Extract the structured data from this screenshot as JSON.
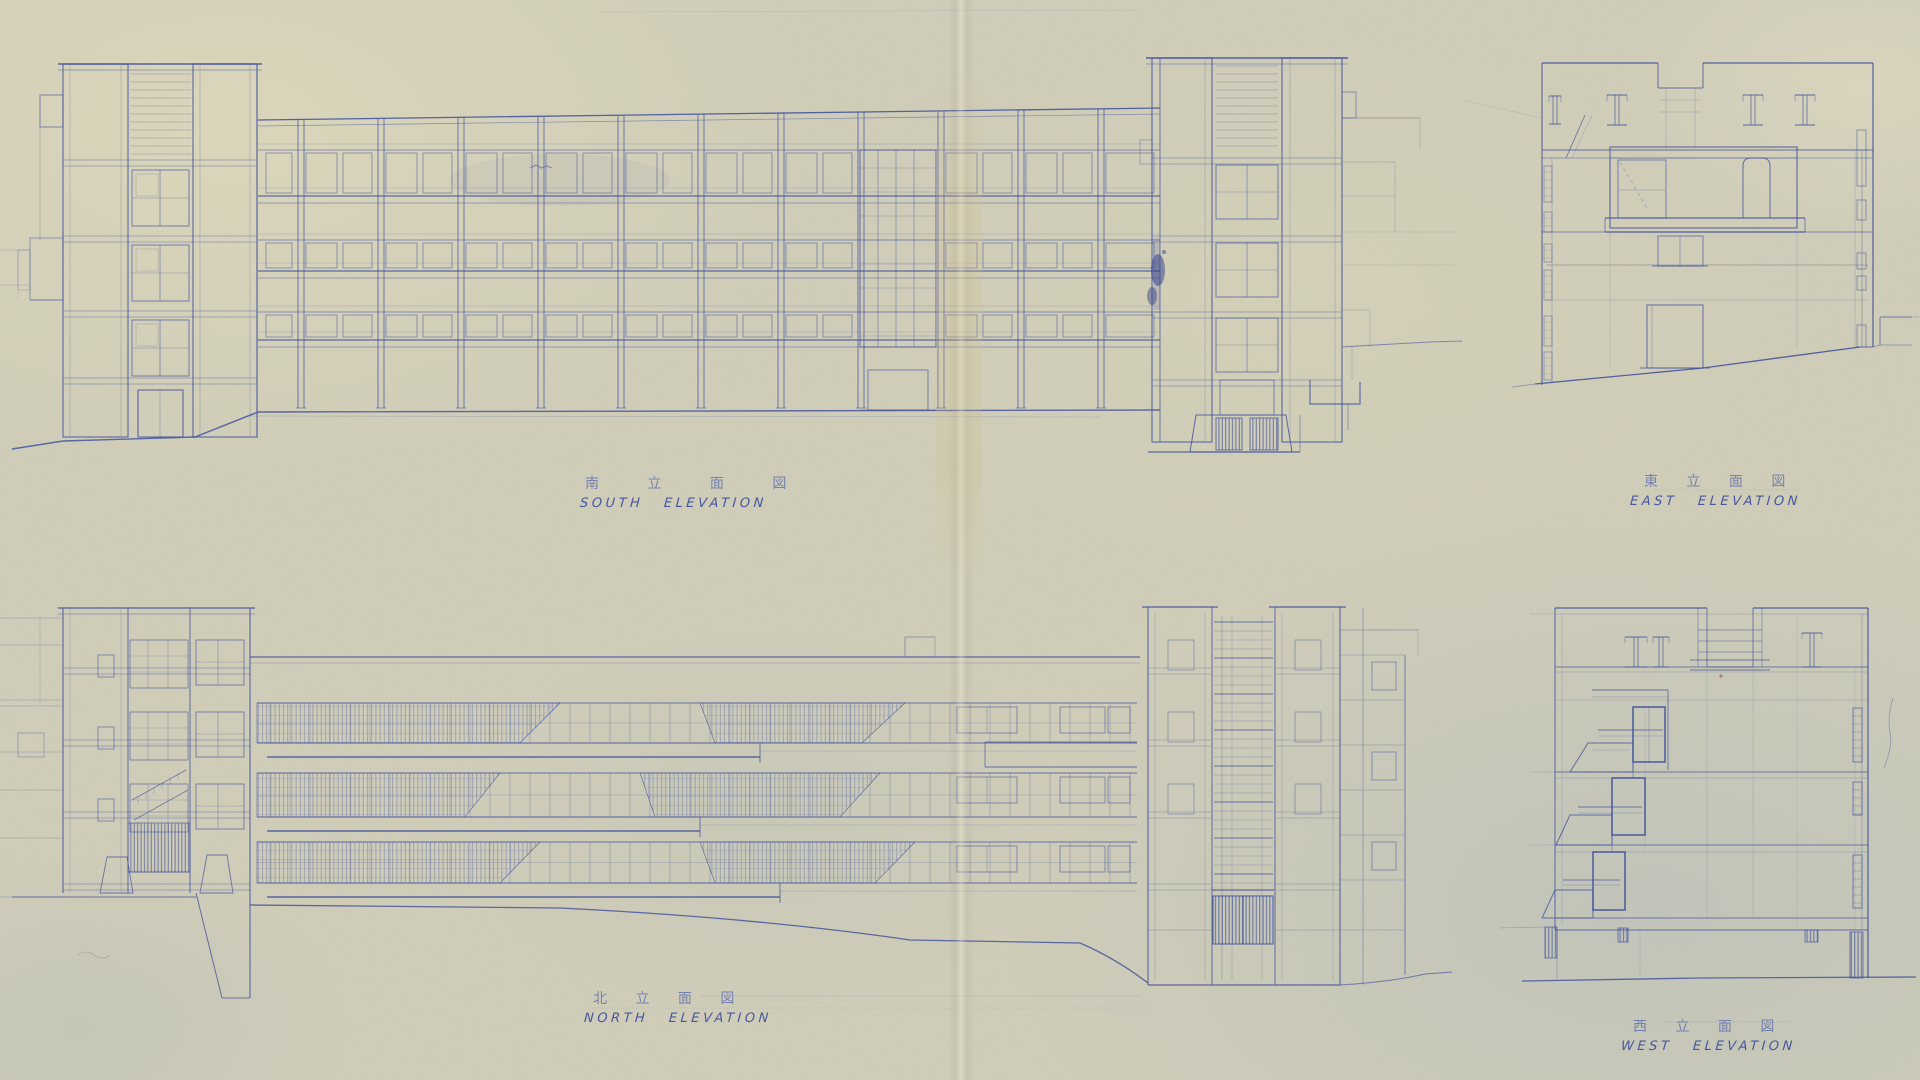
{
  "colors": {
    "paper": "#d0cdb9",
    "ink": "#44549c",
    "ink_dark": "#2c3c8c",
    "ink_faint": "#8a96c4"
  },
  "elevations": {
    "south": {
      "label_jp": "南 立 面 図",
      "label_en": "SOUTH ELEVATION"
    },
    "east": {
      "label_jp": "東 立 面 図",
      "label_en": "EAST ELEVATION"
    },
    "north": {
      "label_jp": "北 立 面 図",
      "label_en": "NORTH ELEVATION"
    },
    "west": {
      "label_jp": "西 立 面 図",
      "label_en": "WEST ELEVATION"
    }
  }
}
